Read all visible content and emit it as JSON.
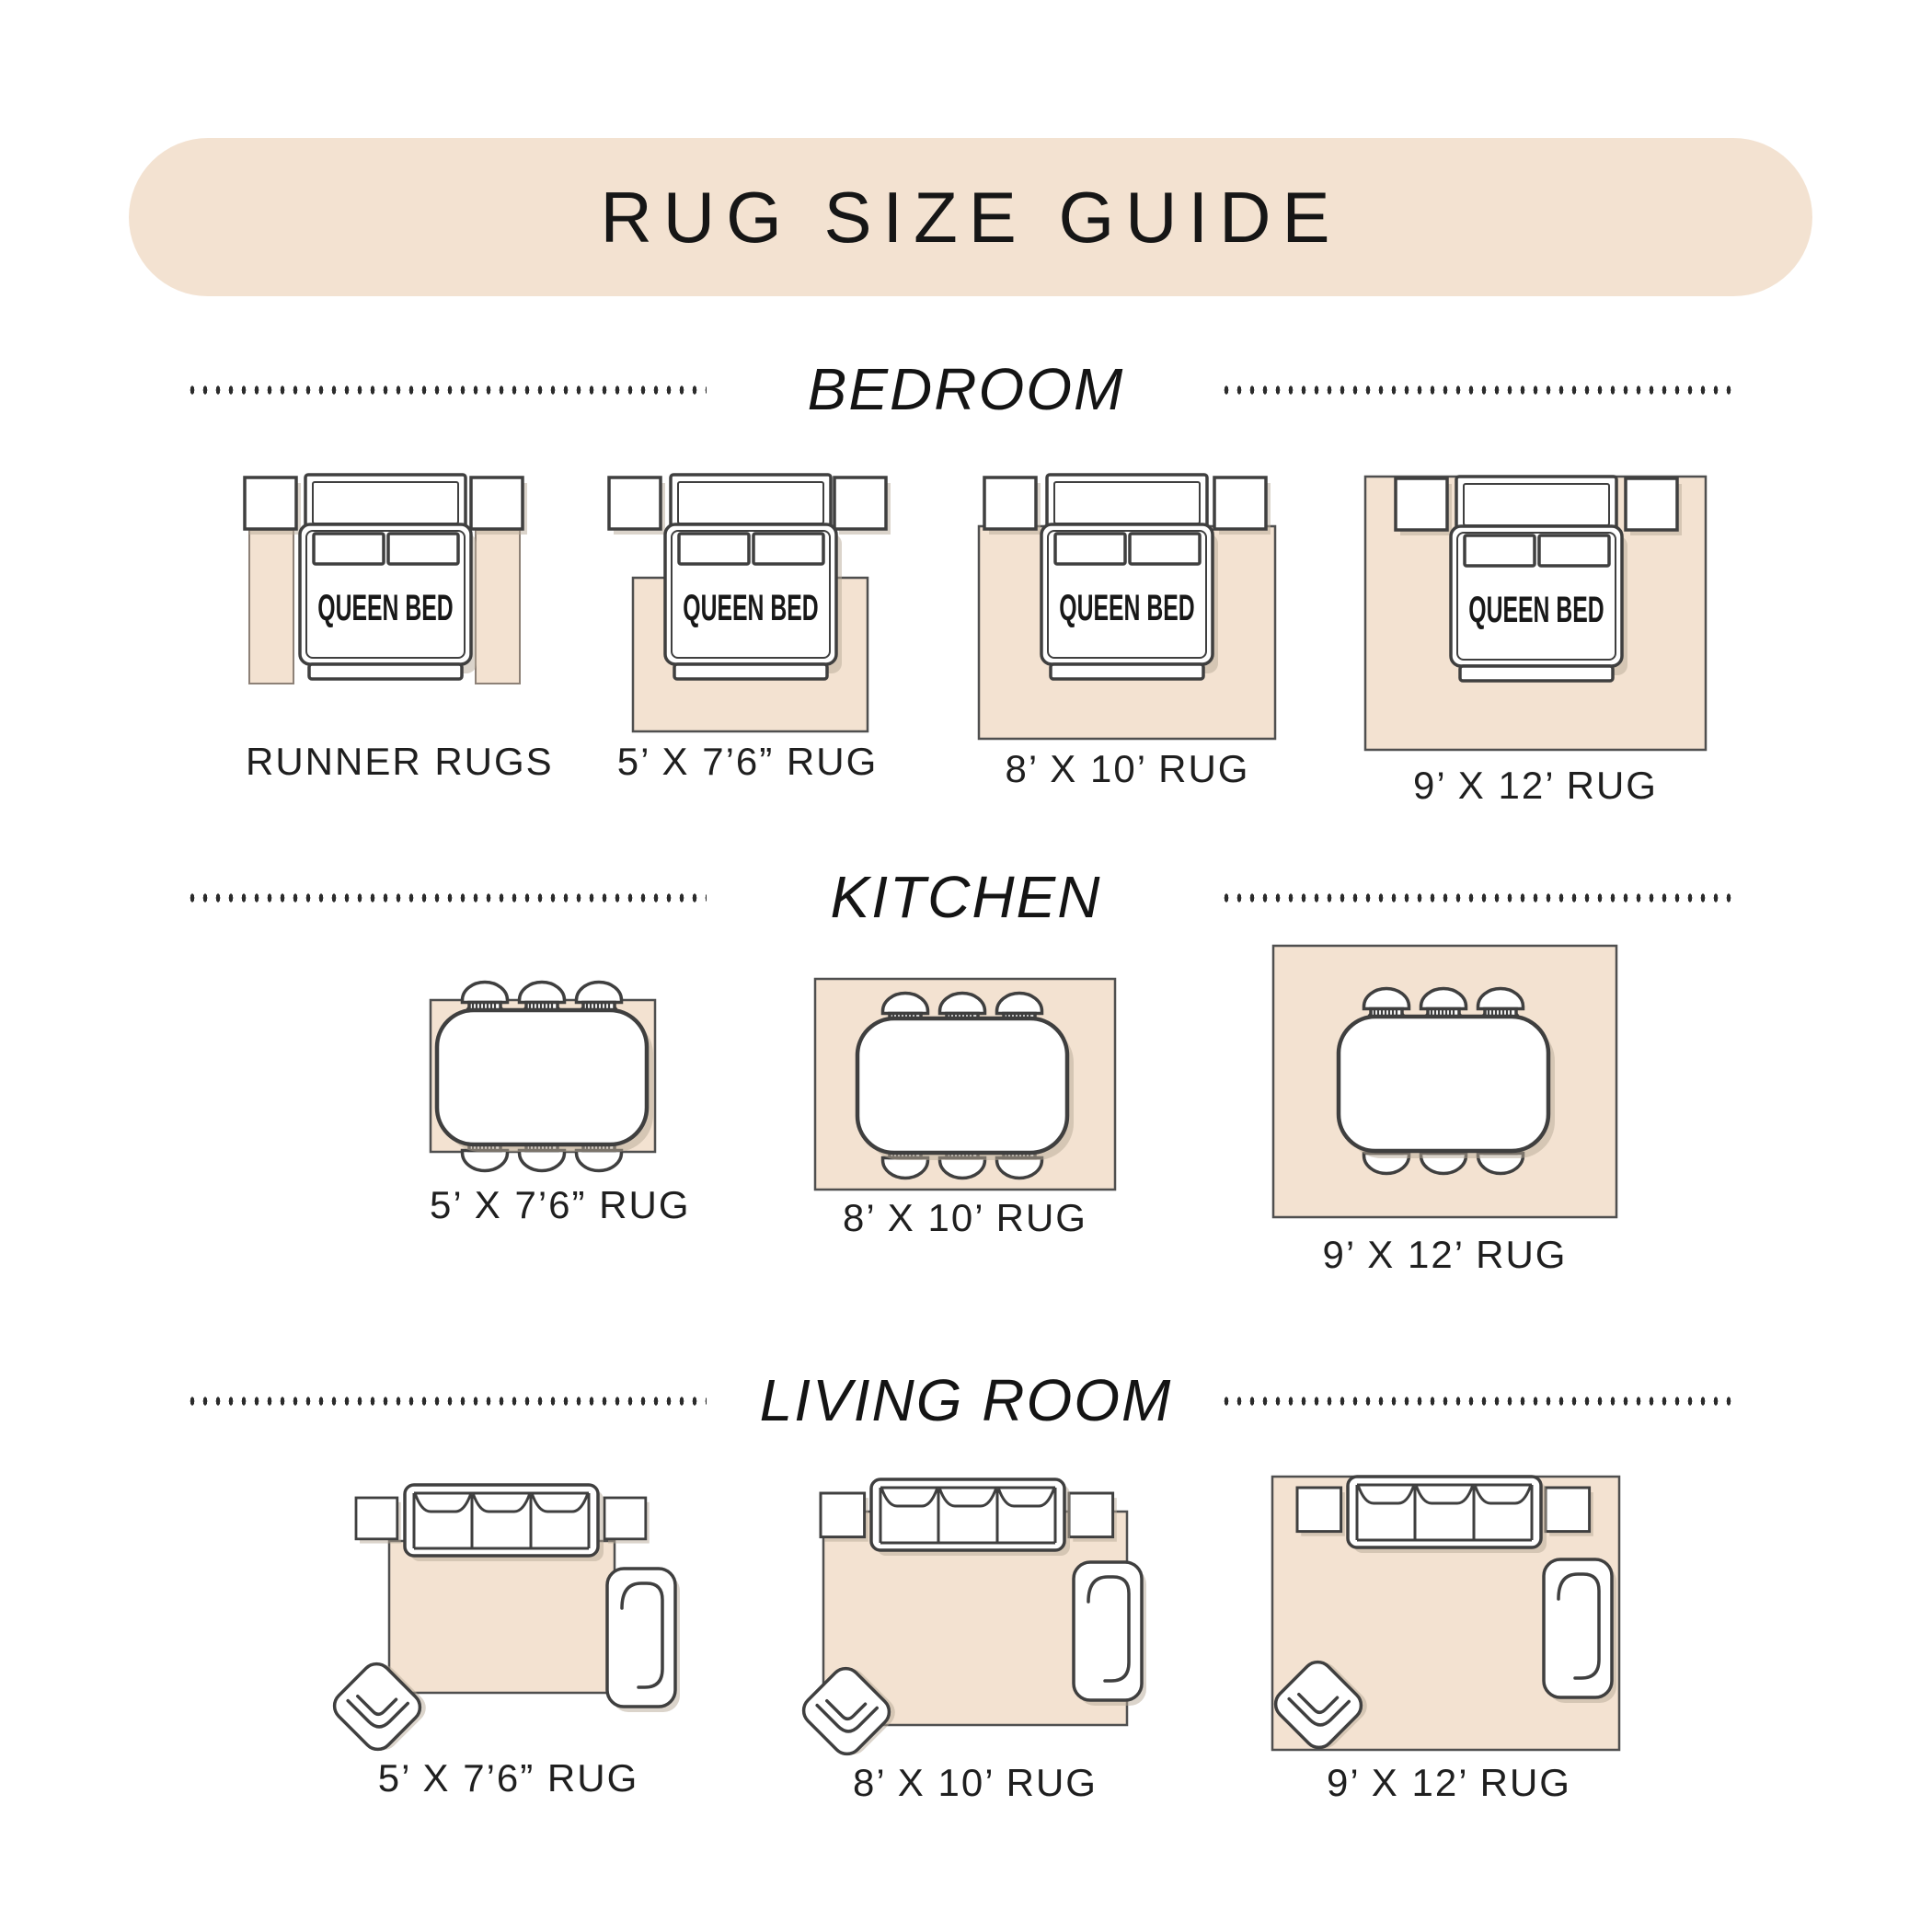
{
  "title_banner": {
    "title": "RUG SIZE GUIDE"
  },
  "sections": {
    "bedroom": {
      "heading": "BEDROOM",
      "bed_label": "QUEEN BED",
      "items": [
        {
          "label": "RUNNER RUGS"
        },
        {
          "label": "5’ X 7’6” RUG"
        },
        {
          "label": "8’ X 10’ RUG"
        },
        {
          "label": "9’ X 12’ RUG"
        }
      ]
    },
    "kitchen": {
      "heading": "KITCHEN",
      "items": [
        {
          "label": "5’ X 7’6” RUG"
        },
        {
          "label": "8’ X 10’ RUG"
        },
        {
          "label": "9’ X 12’ RUG"
        }
      ]
    },
    "living_room": {
      "heading": "LIVING ROOM",
      "items": [
        {
          "label": "5’ X 7’6” RUG"
        },
        {
          "label": "8’ X 10’ RUG"
        },
        {
          "label": "9’ X 12’ RUG"
        }
      ]
    }
  },
  "icons": {
    "queen-bed-icon": "top-down bed outline with headboard, two pillows and footboard",
    "nightstand-icon": "small square table outline",
    "runner-rug": "narrow vertical beige rug",
    "dining-table-icon": "rounded rectangle table outline",
    "dining-chair-icon": "chair with arched back and ribbed cushion",
    "sofa-icon": "three-seat sofa outline seen from above",
    "side-table-icon": "small square table outline",
    "chaise-icon": "lounge chair outline with inner backrest line",
    "armchair-icon": "rotated armchair outline with inner bracket"
  },
  "colors": {
    "beige": "#f3e2d1",
    "line": "#3f3f3f",
    "ink": "#1e1e1e",
    "shadow": "#b7a998"
  }
}
